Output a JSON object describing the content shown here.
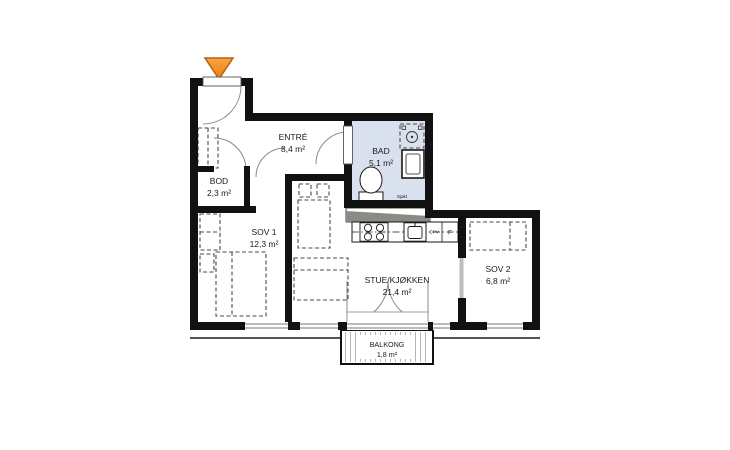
{
  "title": "Apartment floor plan",
  "rooms": [
    {
      "name": "ENTRÉ",
      "area": "8,4 m²"
    },
    {
      "name": "BOD",
      "area": "2,3 m²"
    },
    {
      "name": "BAD",
      "area": "5,1 m²"
    },
    {
      "name": "SOV 1",
      "area": "12,3 m²"
    },
    {
      "name": "STUE/KJØKKEN",
      "area": "21,4 m²"
    },
    {
      "name": "SOV 2",
      "area": "6,8 m²"
    },
    {
      "name": "BALKONG",
      "area": "1,8 m²"
    }
  ],
  "annotations": {
    "shaft": "Sjakt",
    "dishwasher": "OPV",
    "fridge": "F"
  },
  "colors": {
    "wall": "#111111",
    "bathroom_fill": "#d9e1ee",
    "entry_arrow": "#F6941E",
    "entry_arrow_border": "#B85E11",
    "shaft_gray": "#8b8b85"
  }
}
